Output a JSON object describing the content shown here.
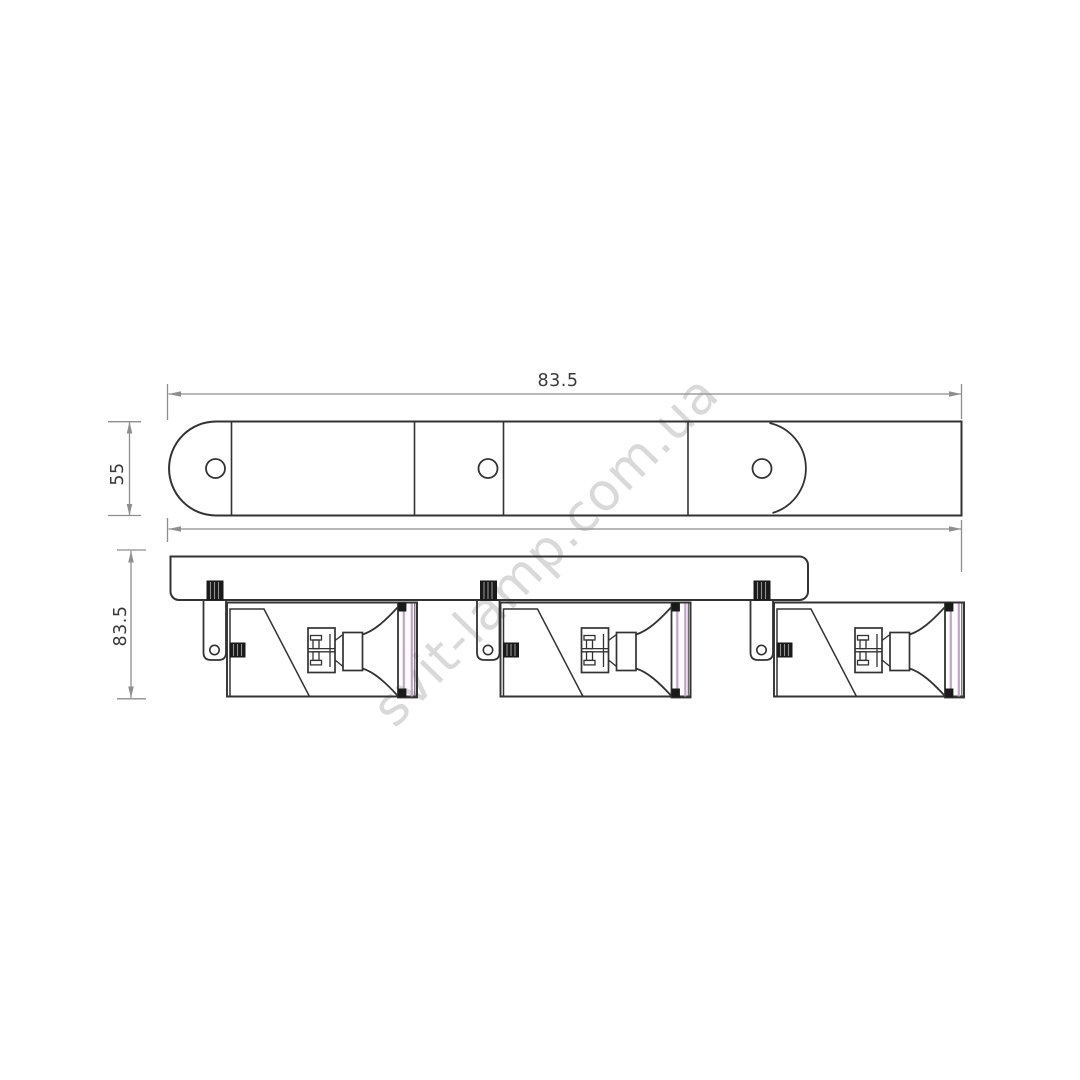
{
  "watermark": {
    "text": "svit-lamp.com.ua"
  },
  "dimensions": {
    "plan_width": "83.5",
    "plan_depth": "55",
    "side_height": "83.5"
  },
  "drawing": {
    "view_count": 2,
    "spotlight_count": 3,
    "mounting_hole_count": 3
  },
  "colors": {
    "line": "#333333",
    "dim": "#8e8e8e",
    "pink": "#c8a0cd",
    "watermark": "#d9d9d9",
    "knob": "#1a1a1a",
    "background": "#ffffff"
  }
}
